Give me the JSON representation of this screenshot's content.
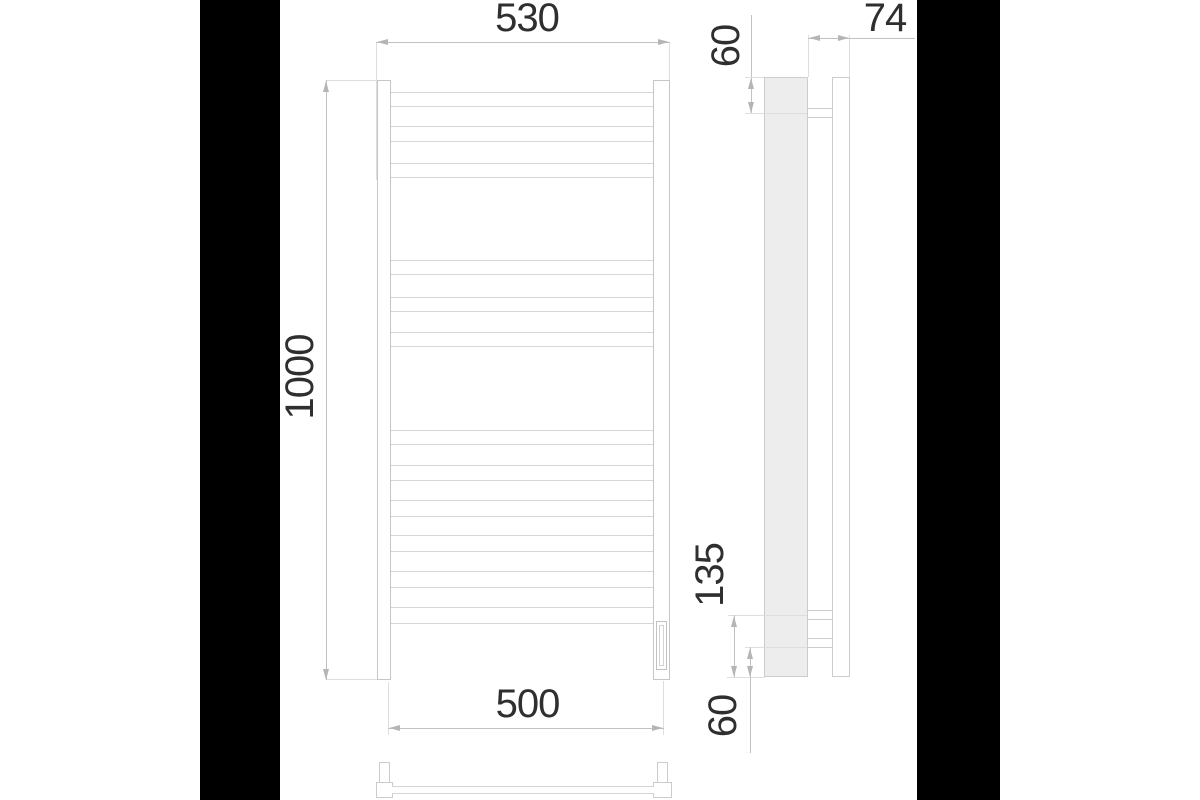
{
  "drawing": {
    "type": "technical-dimension-drawing",
    "subject": "ladder towel rail — front, side and bottom views",
    "colors": {
      "background": "#ffffff",
      "letterbox": "#000000",
      "linework": "#c8c8c8",
      "rung_line": "#d6d6d6",
      "side_profile_fill": "#ededed",
      "dimension_text": "#2f2f2f",
      "arrowhead": "#b5b5b5"
    },
    "dimensions": {
      "top_width": "530",
      "height": "1000",
      "bottom_width": "500",
      "depth": "74",
      "top_bracket_offset": "60",
      "bottom_bracket_span": "135",
      "bottom_bracket_offset": "60"
    },
    "front_view": {
      "rung_count": 12,
      "rung_groups": [
        3,
        3,
        6
      ],
      "rungs": [
        [
          92,
          15
        ],
        [
          126,
          16
        ],
        [
          163,
          15
        ],
        [
          260,
          15
        ],
        [
          297,
          15
        ],
        [
          332,
          15
        ],
        [
          430,
          15
        ],
        [
          465,
          16
        ],
        [
          500,
          17
        ],
        [
          535,
          17
        ],
        [
          571,
          17
        ],
        [
          607,
          17
        ]
      ]
    },
    "side_view": {
      "bracket_count": 3
    }
  }
}
